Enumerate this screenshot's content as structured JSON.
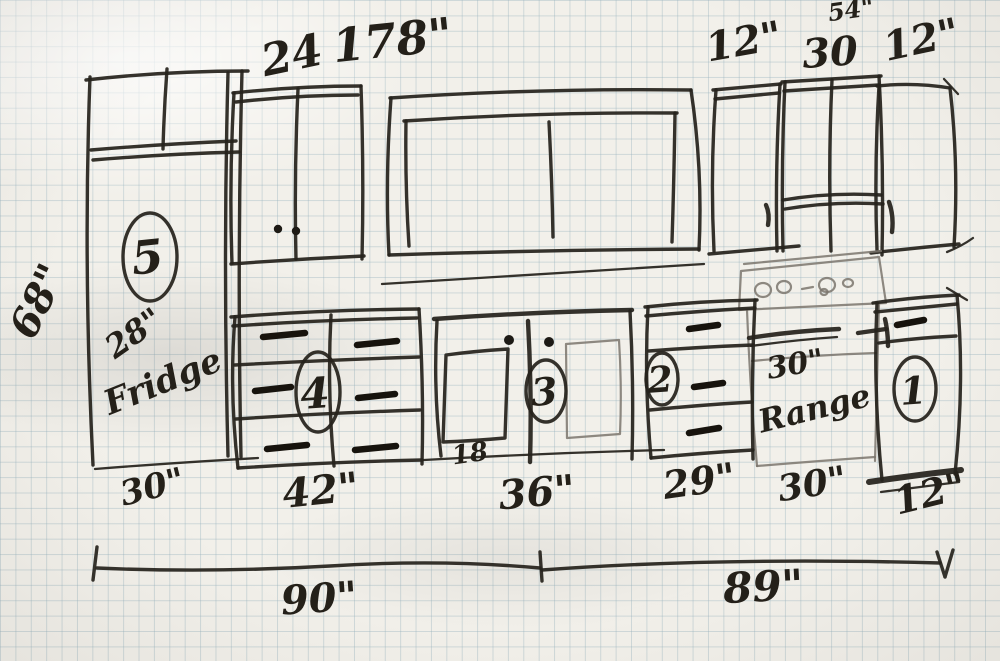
{
  "sketch": {
    "subject": "hand-drawn kitchen cabinet elevation on graph paper"
  },
  "dimensions": {
    "top": {
      "cabinet_24": "24",
      "wall_178": "178\"",
      "upper_left_12": "12\"",
      "upper_30": "30",
      "upper_right_12": "12\"",
      "upper_total_54": "54\""
    },
    "left": {
      "height_68": "68\""
    },
    "base": {
      "fridge_30": "30\"",
      "drawers_42": "42\"",
      "sink_36": "36\"",
      "sink_door_18": "18",
      "cab_29": "29\"",
      "range_30": "30\"",
      "end_12": "12\""
    },
    "overall": {
      "left_90": "90\"",
      "right_89": "89\""
    }
  },
  "appliances": {
    "fridge": {
      "size": "28\"",
      "name": "Fridge"
    },
    "range": {
      "size": "30\"",
      "name": "Range"
    }
  },
  "cabinet_numbers": {
    "n1": "1",
    "n2": "2",
    "n3": "3",
    "n4": "4",
    "n5": "5"
  }
}
